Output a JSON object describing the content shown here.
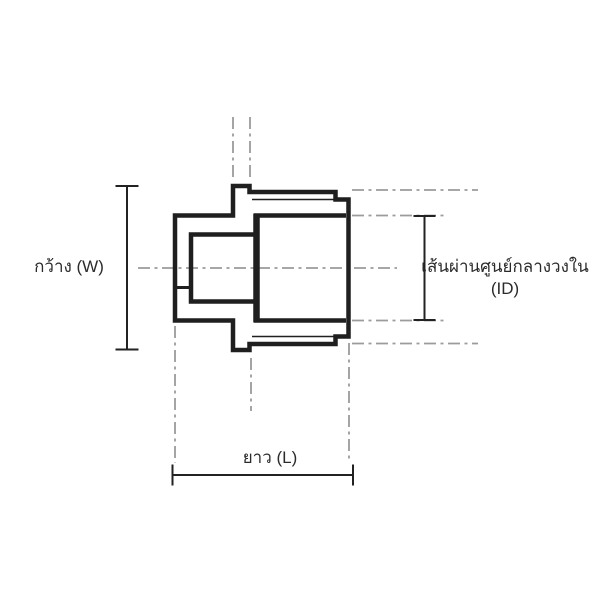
{
  "drawing": {
    "labels": {
      "width_label": "กว้าง (W)",
      "id_label_line1": "เส้นผ่านศูนย์กลางวงใน",
      "id_label_line2": "(ID)",
      "length_label": "ยาว (L)"
    },
    "colors": {
      "background": "#ffffff",
      "outline": "#1f1f1f",
      "centerline": "#9b9b9b",
      "dimension": "#222222",
      "text": "#2b2b2b"
    }
  }
}
